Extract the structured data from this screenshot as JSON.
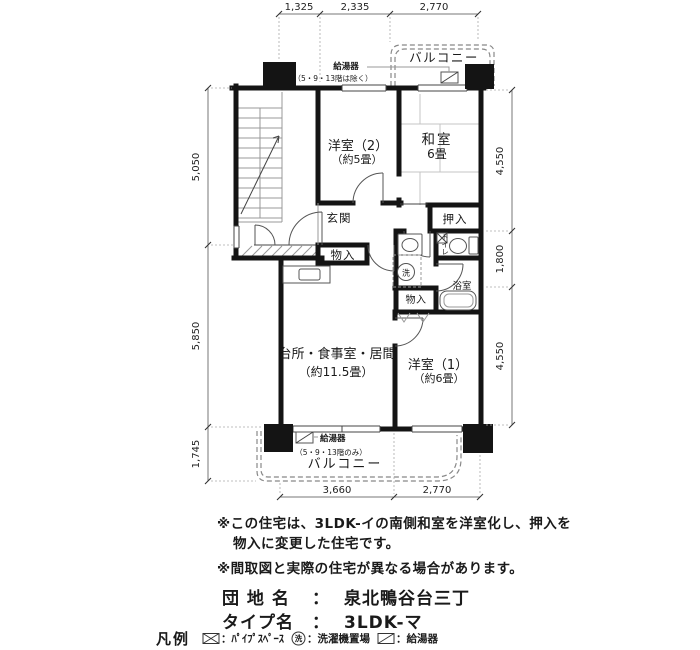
{
  "plan": {
    "dims": {
      "top": [
        "1,325",
        "2,335",
        "2,770"
      ],
      "left": [
        "5,050",
        "5,850",
        "1,745"
      ],
      "right": [
        "4,550",
        "1,800",
        "4,550"
      ],
      "bottom": [
        "3,660",
        "2,770"
      ]
    },
    "rooms": {
      "balcony_top": "バルコニー",
      "balcony_bottom": "バルコニー",
      "yoshitsu2_name": "洋室（2）",
      "yoshitsu2_size": "（約5畳）",
      "washitsu_name": "和室",
      "washitsu_size": "6畳",
      "genkan": "玄関",
      "oshiire": "押入",
      "monoire_hall": "物入",
      "monoire_lower": "物入",
      "toilet": "トイレ",
      "bath": "浴室",
      "laundry": "洗",
      "ldk_name": "台所・食事室・居間",
      "ldk_size": "（約11.5畳）",
      "yoshitsu1_name": "洋室（1）",
      "yoshitsu1_size": "（約6畳）"
    },
    "heaters": {
      "top_label": "給湯器",
      "top_note": "（5・9・13階は除く）",
      "bottom_label": "給湯器",
      "bottom_note": "（5・9・13階のみ）"
    }
  },
  "notes": {
    "line1": "※この住宅は、3LDK-イの南側和室を洋室化し、押入を",
    "line2": "物入に変更した住宅です。",
    "line3": "※間取図と実際の住宅が異なる場合があります。"
  },
  "info": {
    "danchi_label": "団 地 名",
    "colon": "：",
    "danchi_value": "泉北鴨谷台三丁",
    "type_label": "タイプ名",
    "type_value": "3LDK-マ"
  },
  "legend": {
    "title": "凡例",
    "pipe_label": "：ﾊﾟｲﾌﾟｽﾍﾟｰｽ",
    "laundry_glyph": "洗",
    "laundry_label": "：洗濯機置場",
    "heater_label": "：給湯器"
  },
  "colors": {
    "ink": "#1a1a1a",
    "wall": "#141414",
    "dim": "#555555"
  }
}
